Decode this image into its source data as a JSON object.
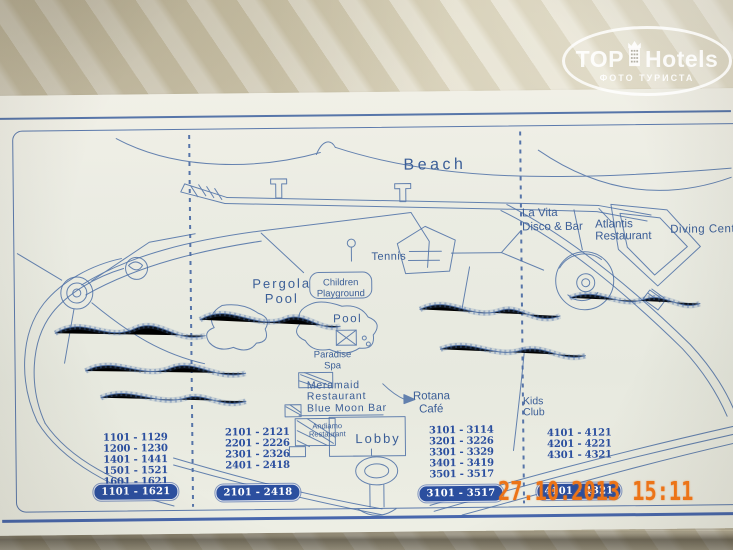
{
  "logo": {
    "top": "TOP",
    "hotels": "Hotels",
    "subtitle": "ФОТО ТУРИСТА"
  },
  "timestamp": "27.10.2013 15:11",
  "colors": {
    "map_ink": "#4c6fa6",
    "label_text": "#3b5e97",
    "badge_bg": "#2b4f9f",
    "badge_text": "#ffffff",
    "timestamp": "#ec7418"
  },
  "map": {
    "labels": {
      "beach": "Beach",
      "la_vita_1": "La Vita",
      "la_vita_2": "Disco & Bar",
      "atlantis_1": "Atlantis",
      "atlantis_2": "Restaurant",
      "diving": "Diving Center",
      "tennis": "Tennis",
      "pergola_1": "Pergola",
      "pergola_2": "Pool",
      "children_1": "Children",
      "children_2": "Playground",
      "pool": "Pool",
      "paradise_1": "Paradise",
      "paradise_2": "Spa",
      "meramaid_1": "Meramaid",
      "meramaid_2": "Restaurant",
      "blue_moon": "Blue Moon Bar",
      "andiamo_1": "Andiamo",
      "andiamo_2": "Restaurant",
      "lobby": "Lobby",
      "rotana_1": "Rotana",
      "rotana_2": "Café",
      "kids_1": "Kids",
      "kids_2": "Club"
    }
  },
  "rooms": {
    "columns": [
      {
        "rows": [
          "1101 - 1129",
          "1200 - 1230",
          "1401 - 1441",
          "1501 - 1521",
          "1601 - 1621"
        ],
        "badge": "1101 - 1621"
      },
      {
        "rows": [
          "2101 - 2121",
          "2201 - 2226",
          "2301 - 2326",
          "2401 - 2418"
        ],
        "badge": "2101 - 2418"
      },
      {
        "rows": [
          "3101 - 3114",
          "3201 - 3226",
          "3301 - 3329",
          "3401 - 3419",
          "3501 - 3517"
        ],
        "badge": "3101 - 3517"
      },
      {
        "rows": [
          "4101 - 4121",
          "4201 - 4221",
          "4301 - 4321"
        ],
        "badge": "4101 - 4321"
      }
    ]
  }
}
